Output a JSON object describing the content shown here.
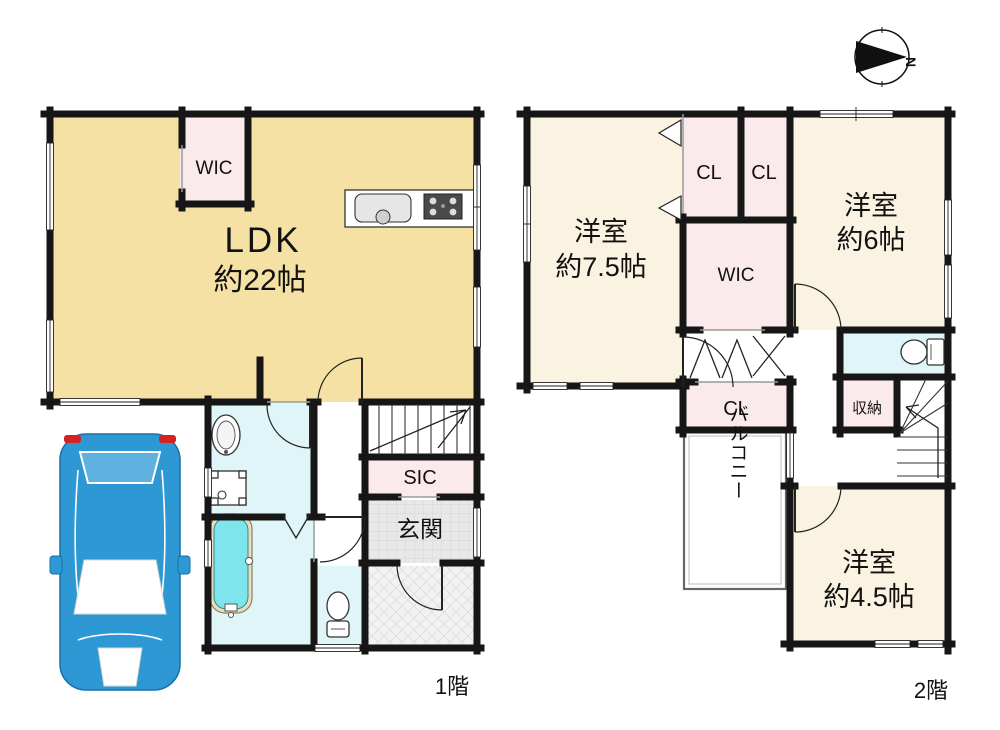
{
  "title": "間取り図",
  "compass": {
    "north": "N"
  },
  "floor1": {
    "label": "1階",
    "ldk": {
      "line1": "LDK",
      "line2": "約22帖"
    },
    "wic": "WIC",
    "sic": "SIC",
    "genkan": "玄関"
  },
  "floor2": {
    "label": "2階",
    "room75": {
      "line1": "洋室",
      "line2": "約7.5帖"
    },
    "room6": {
      "line1": "洋室",
      "line2": "約6帖"
    },
    "room45": {
      "line1": "洋室",
      "line2": "約4.5帖"
    },
    "cl_top_left": "CL",
    "cl_top_right": "CL",
    "wic": "WIC",
    "cl_lower": "CL",
    "storage": "収納",
    "balcony": "バルコニー"
  },
  "colors": {
    "wall": "#161616",
    "ldk": "#f5e1a4",
    "room": "#faf3e2",
    "closet": "#fbeaeb",
    "wet": "#dff5f7",
    "tub": "#7fe5ec",
    "entrance": "#e8e8e8",
    "porch": "#f2f2f2",
    "car": "#2e98d5",
    "car_edge": "#1a6fa6",
    "tail": "#d42222",
    "glass": "#5fb2e0"
  }
}
